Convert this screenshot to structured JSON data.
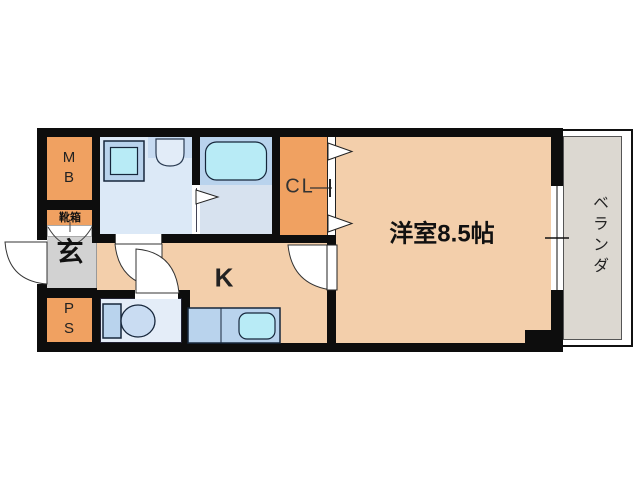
{
  "plan": {
    "rooms": {
      "meter_box": {
        "label": "MB"
      },
      "shoe_box": {
        "label": "靴箱"
      },
      "entrance": {
        "label": "玄"
      },
      "pipe_space": {
        "label": "PS"
      },
      "closet": {
        "label": "CL"
      },
      "kitchen": {
        "label": "K"
      },
      "western_room": {
        "label": "洋室8.5帖"
      },
      "veranda": {
        "label": "ベランダ"
      }
    },
    "fixtures": [
      {
        "name": "washing-machine-icon"
      },
      {
        "name": "wash-basin-icon"
      },
      {
        "name": "bathtub-icon"
      },
      {
        "name": "toilet-icon"
      },
      {
        "name": "kitchen-sink-icon"
      },
      {
        "name": "sliding-window-icon"
      },
      {
        "name": "entrance-door-swing-icon"
      },
      {
        "name": "closet-folding-door-icon"
      }
    ],
    "colors": {
      "wall": "#0d0d0d",
      "orange": "#f0a161",
      "peach": "#f3cfab",
      "washroom": "#dce9f7",
      "bath": "#d7e2ef",
      "toilet": "#e4edf8",
      "panel": "#b9d3ed",
      "cyan": "#b8ebf6",
      "genkan": "#d2d2d2",
      "veranda": "#dcd8d1"
    }
  }
}
